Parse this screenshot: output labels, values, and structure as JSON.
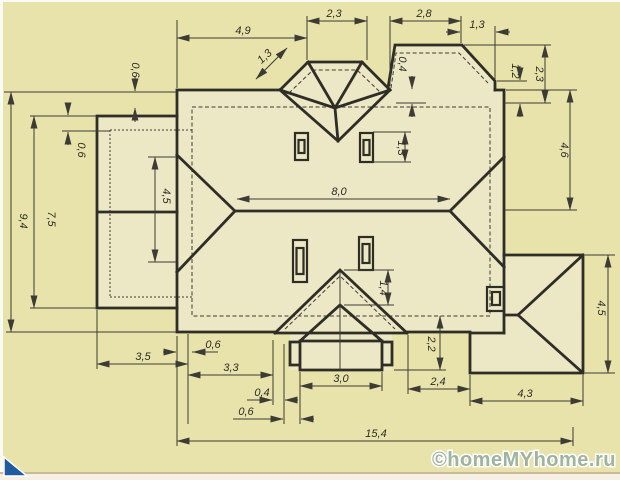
{
  "watermark": {
    "text": "©homeMYhome.ru",
    "color": "#9fb49e"
  },
  "colors": {
    "paper": "#e8e2ab",
    "shape_fill": "#ece8c5",
    "outline": "#2e2d26",
    "thin_line": "#3c3c34",
    "corner_triangle": "#1f5b9d",
    "bottom_strip": "#f6efe3",
    "bottom_rule": "#c9b89a"
  },
  "dims": {
    "top_49": "4,9",
    "top_23": "2,3",
    "top_28": "2,8",
    "top_13": "1,3",
    "bay_13": "1,3",
    "bay_04": "0,4",
    "left_94": "9,4",
    "left_75": "7,5",
    "left_06_annex": "0,6",
    "top_06_main": "0,6",
    "annex_45": "4,5",
    "ridge_80": "8,0",
    "chimney_13": "1,3",
    "porch_14": "1,4",
    "right_12": "1,2",
    "right_23": "2,3",
    "right_46": "4,6",
    "garage_45": "4,5",
    "bottom_06_eave": "0,6",
    "bottom_35": "3,5",
    "bottom_33": "3,3",
    "bottom_04": "0,4",
    "bottom_06_porch": "0,6",
    "porch_30": "3,0",
    "right_22": "2,2",
    "bottom_24": "2,4",
    "bottom_43": "4,3",
    "total_154": "15,4"
  }
}
